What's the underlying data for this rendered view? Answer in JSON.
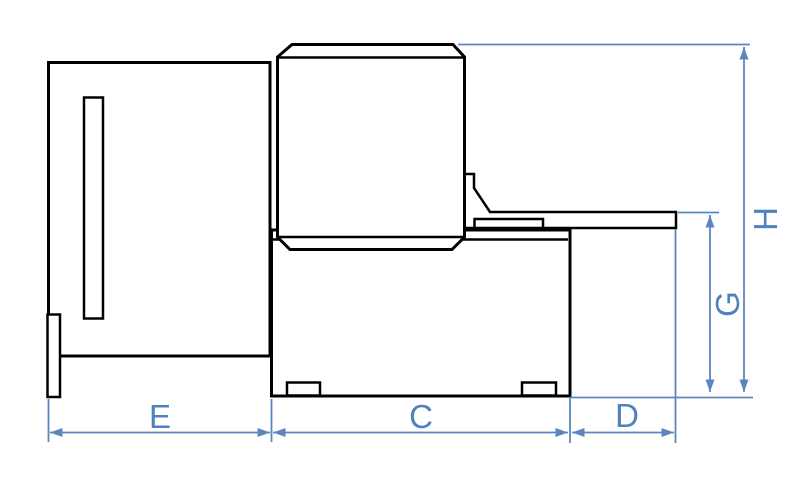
{
  "diagram": {
    "type": "technical-dimension-drawing",
    "view": "machine-side-view",
    "colors": {
      "background": "#ffffff",
      "outline": "#000000",
      "dimension": "#4f81bd",
      "dimension_line": "#5b87be"
    },
    "dimensions": {
      "bottom": [
        {
          "id": "E",
          "label": "E"
        },
        {
          "id": "C",
          "label": "C"
        },
        {
          "id": "D",
          "label": "D"
        }
      ],
      "right": [
        {
          "id": "G",
          "label": "G"
        },
        {
          "id": "H",
          "label": "H"
        }
      ]
    }
  }
}
